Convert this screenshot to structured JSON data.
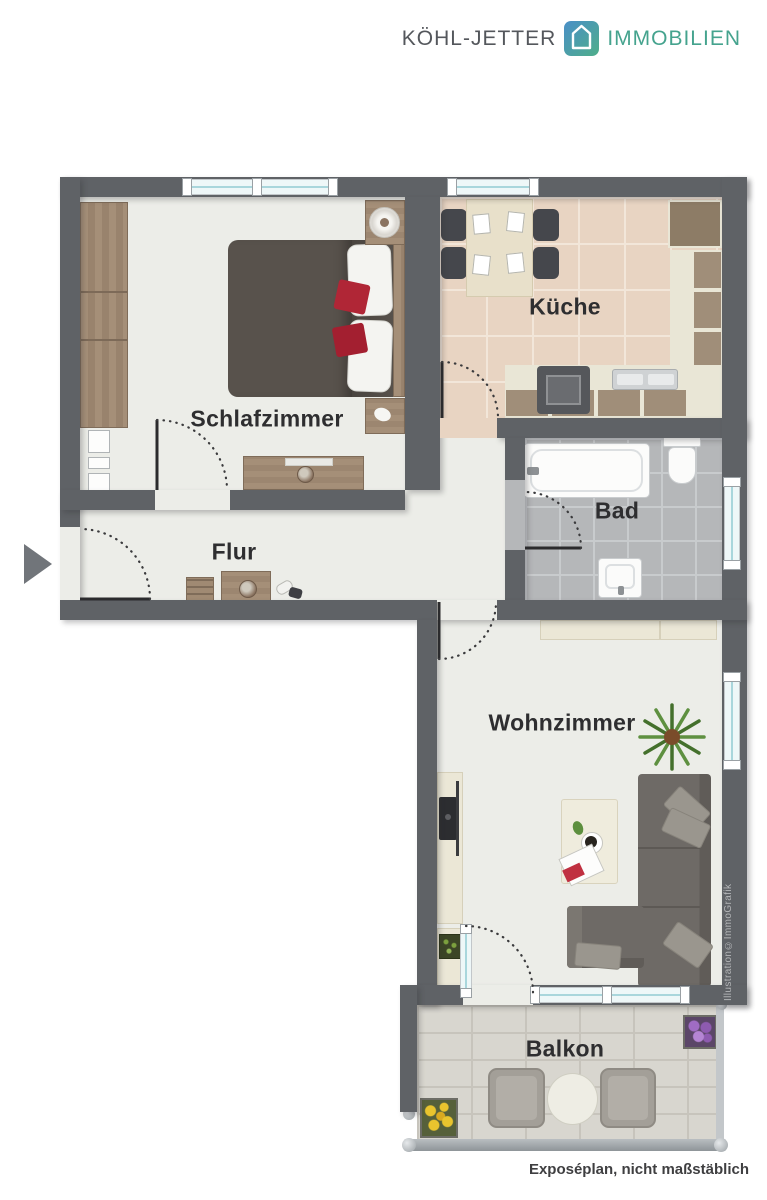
{
  "brand": {
    "name": "KÖHL-JETTER",
    "suffix": "IMMOBILIEN",
    "icon": "house-icon",
    "colors": {
      "name_text": "#54575c",
      "suffix_text": "#45a38e",
      "icon_gradient_start": "#4a8fc7",
      "icon_gradient_end": "#4fae8a"
    }
  },
  "rooms": {
    "bedroom": {
      "label": "Schlafzimmer"
    },
    "kitchen": {
      "label": "Küche"
    },
    "bathroom": {
      "label": "Bad"
    },
    "hallway": {
      "label": "Flur"
    },
    "living_room": {
      "label": "Wohnzimmer"
    },
    "balcony": {
      "label": "Balkon"
    }
  },
  "footer": {
    "disclaimer": "Exposéplan, nicht maßstäblich"
  },
  "watermark": {
    "credit": "Illustration©ImmoGrafik"
  },
  "icons": {
    "logo": "house-icon",
    "entrance": "entrance-arrow-icon"
  },
  "plan_colors": {
    "wall": "#5f6266",
    "floor": "#ecede8",
    "kitchen_tile": "#e8d4c2",
    "bathroom_tile": "#b5b7b9",
    "balcony_tile": "#d8d6cf",
    "window_glass": "#a9d6dc",
    "cushion_red": "#b02636",
    "sofa_gray": "#6e6a66",
    "wood": "#a18b75"
  }
}
